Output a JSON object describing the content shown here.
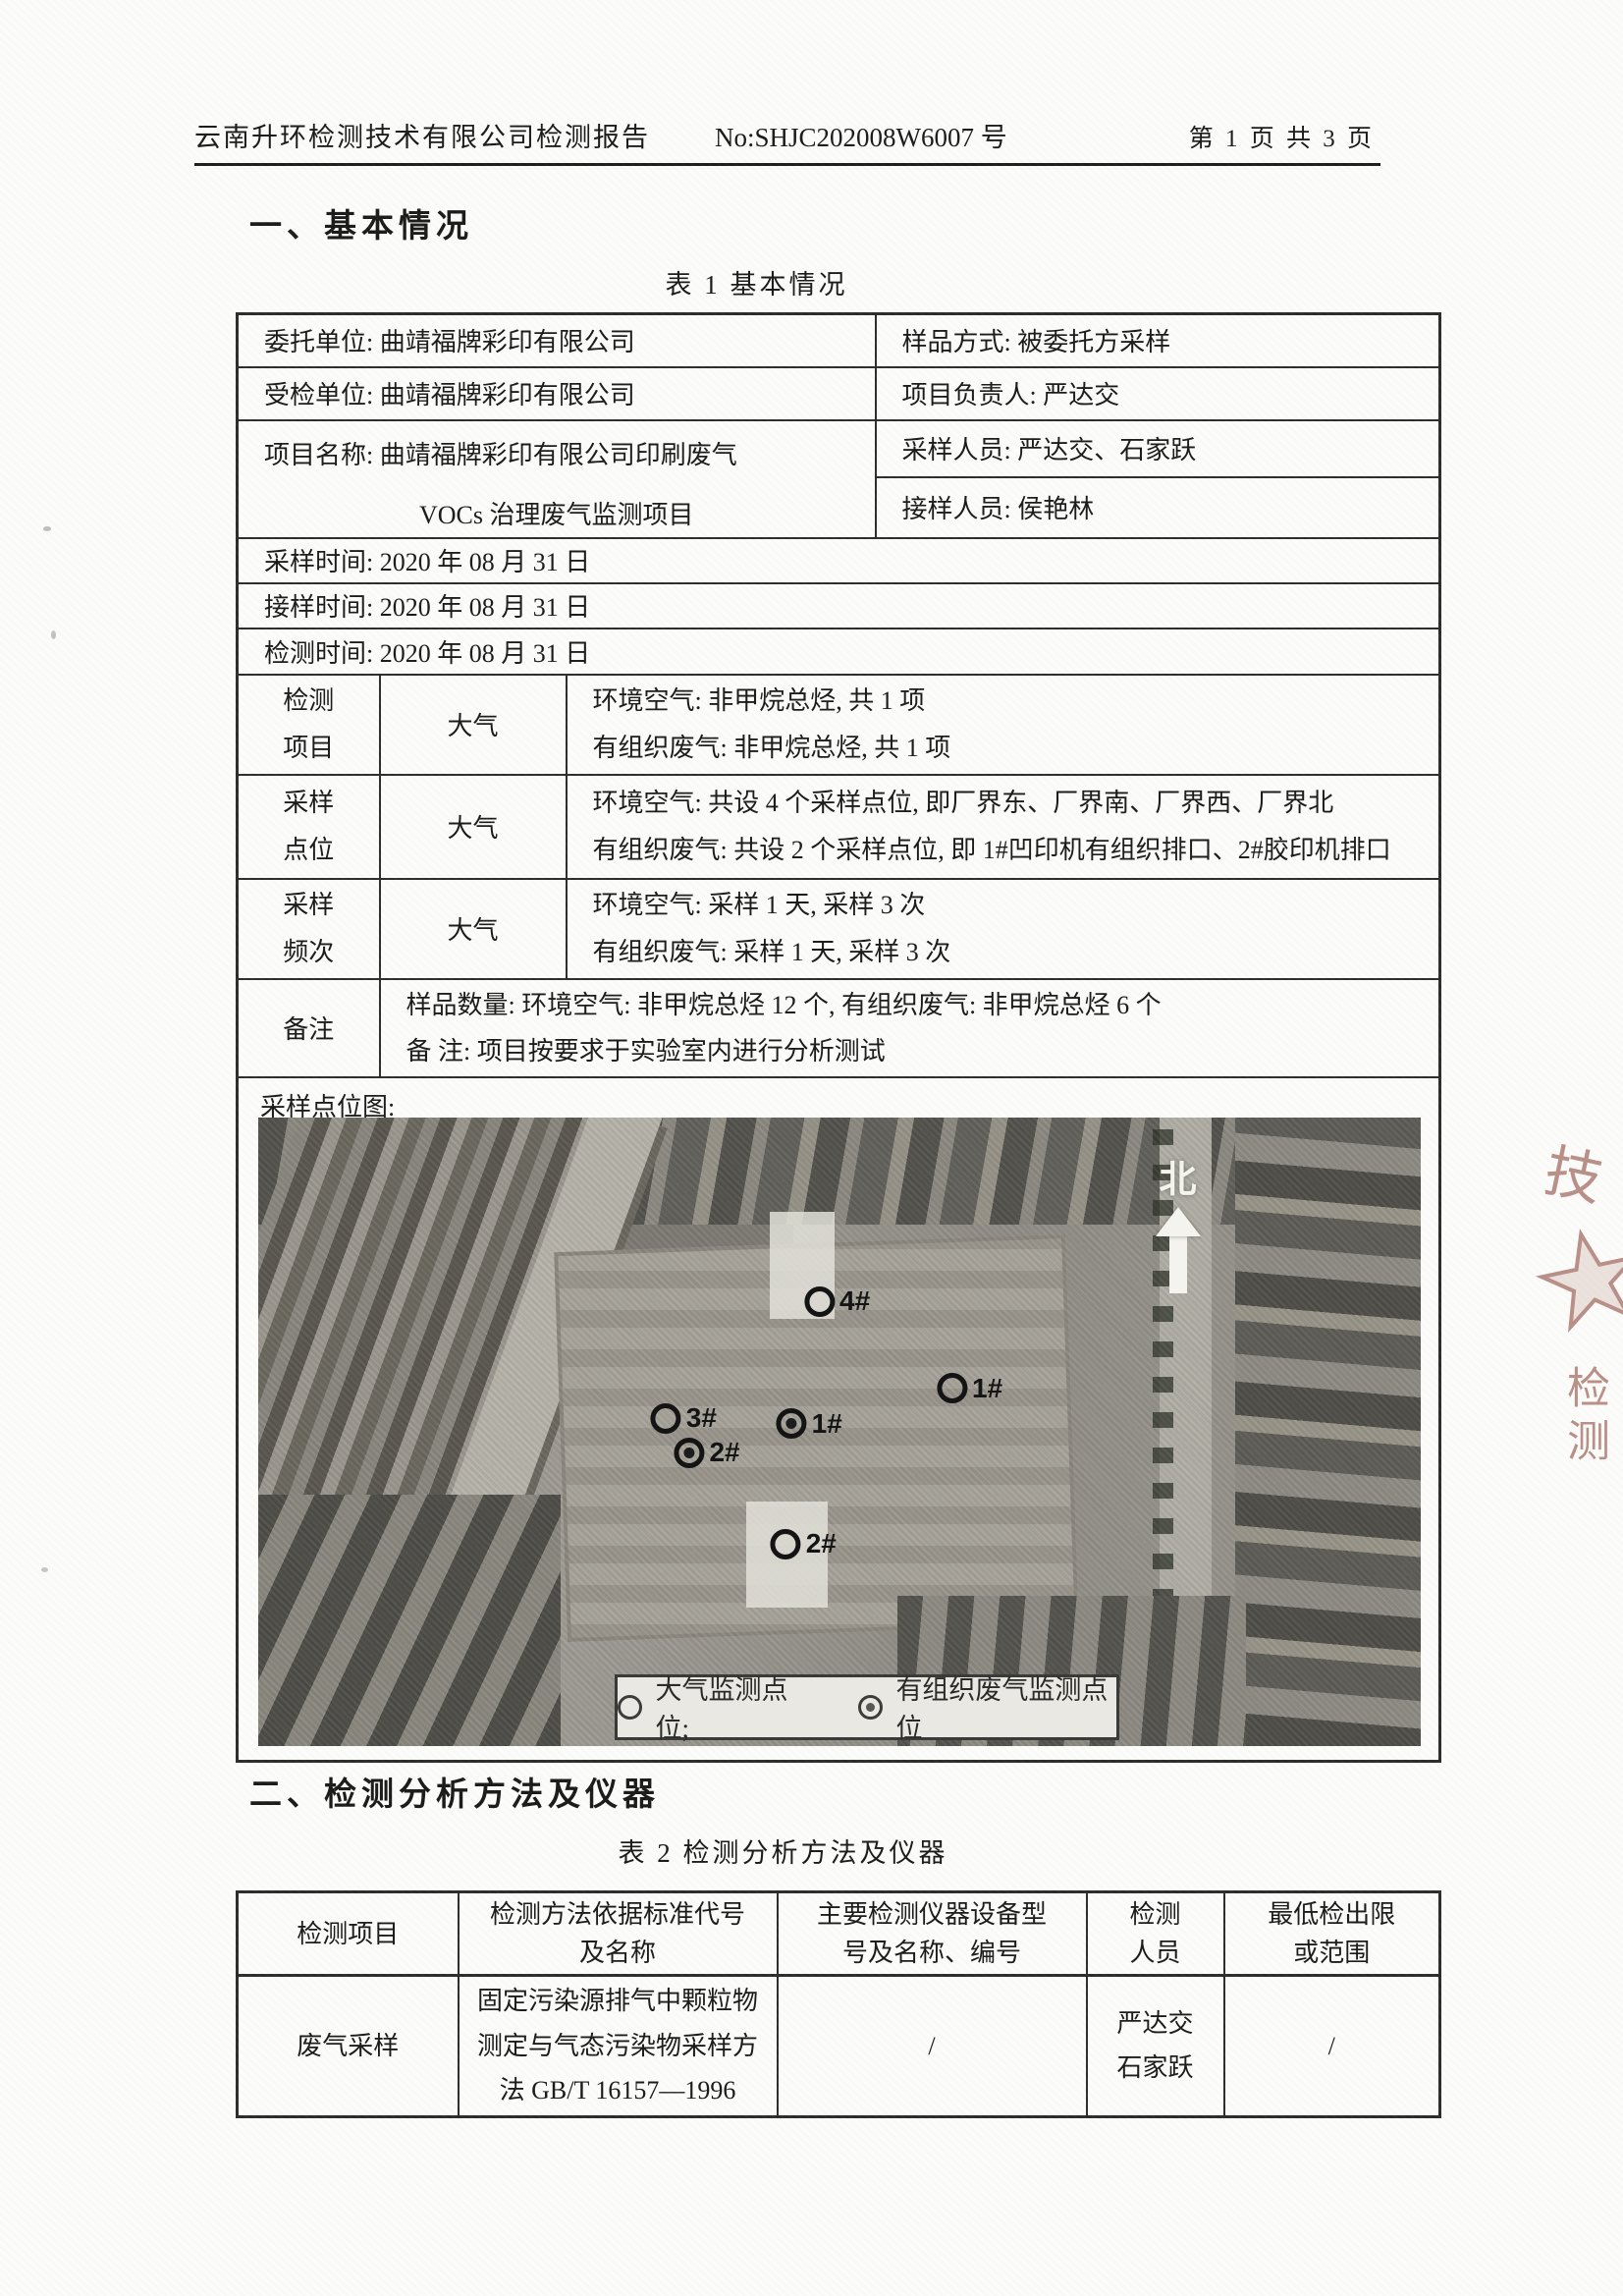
{
  "header": {
    "title": "云南升环检测技术有限公司检测报告",
    "report_no": "No:SHJC202008W6007 号",
    "page_info": "第 1 页 共 3 页"
  },
  "section1": {
    "title": "一、基本情况",
    "table_caption": "表 1 基本情况"
  },
  "table1": {
    "entrust": "委托单位: 曲靖福牌彩印有限公司",
    "sample_method": "样品方式: 被委托方采样",
    "inspected": "受检单位: 曲靖福牌彩印有限公司",
    "project_leader": "项目负责人: 严达交",
    "project_name_line1": "项目名称: 曲靖福牌彩印有限公司印刷废气",
    "project_name_line2": "VOCs 治理废气监测项目",
    "samplers": "采样人员: 严达交、石家跃",
    "receiver": "接样人员: 侯艳林",
    "sampling_time": "采样时间: 2020 年 08 月 31 日",
    "receiving_time": "接样时间: 2020 年 08 月 31 日",
    "testing_time": "检测时间: 2020 年 08 月 31 日",
    "items": {
      "label": "检测\n项目",
      "medium": "大气",
      "content": "环境空气: 非甲烷总烃, 共 1 项\n有组织废气: 非甲烷总烃, 共 1 项"
    },
    "points": {
      "label": "采样\n点位",
      "medium": "大气",
      "content": "环境空气: 共设 4 个采样点位, 即厂界东、厂界南、厂界西、厂界北\n有组织废气: 共设 2 个采样点位, 即 1#凹印机有组织排口、2#胶印机排口"
    },
    "frequency": {
      "label": "采样\n频次",
      "medium": "大气",
      "content": "环境空气: 采样 1 天, 采样 3 次\n有组织废气: 采样 1 天, 采样 3 次"
    },
    "remark": {
      "label": "备注",
      "content": "样品数量: 环境空气: 非甲烷总烃 12 个, 有组织废气: 非甲烷总烃 6 个\n备    注: 项目按要求于实验室内进行分析测试"
    }
  },
  "map": {
    "label": "采样点位图:",
    "north_label": "北",
    "legend": {
      "air": "大气监测点位;",
      "organized": "有组织废气监测点位"
    },
    "markers": [
      {
        "id": "4#",
        "type": "air",
        "x": 49.8,
        "y": 29.2
      },
      {
        "id": "1#",
        "type": "air",
        "x": 61.2,
        "y": 43.1
      },
      {
        "id": "3#",
        "type": "air",
        "x": 36.6,
        "y": 47.8
      },
      {
        "id": "2#",
        "type": "organized",
        "x": 38.6,
        "y": 53.3
      },
      {
        "id": "1#",
        "type": "organized",
        "x": 47.4,
        "y": 48.7
      },
      {
        "id": "2#",
        "type": "air",
        "x": 46.9,
        "y": 67.8
      }
    ]
  },
  "section2": {
    "title": "二、检测分析方法及仪器",
    "table_caption": "表 2 检测分析方法及仪器"
  },
  "table2": {
    "h1": "检测项目",
    "h2": "检测方法依据标准代号\n及名称",
    "h3": "主要检测仪器设备型\n号及名称、编号",
    "h4": "检测\n人员",
    "h5": "最低检出限\n或范围",
    "row": {
      "item": "废气采样",
      "method": "固定污染源排气中颗粒物\n测定与气态污染物采样方\n法 GB/T 16157—1996",
      "instrument": "/",
      "personnel": "严达交\n石家跃",
      "limit": "/"
    }
  },
  "stamp": {
    "char_top": "技",
    "char_bottom": "检测"
  }
}
